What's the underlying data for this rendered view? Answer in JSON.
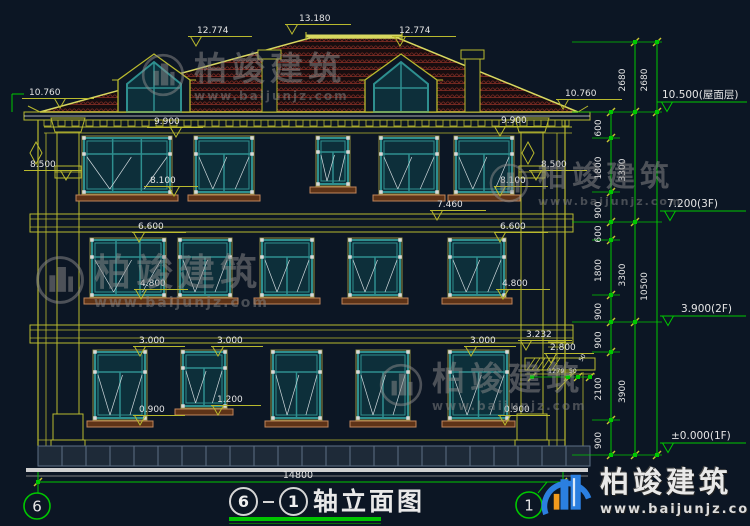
{
  "drawing": {
    "title": {
      "axis_a": "6",
      "axis_b": "1",
      "name": "轴立面图"
    },
    "bottom_dim": {
      "value": "14800"
    },
    "axis_bubbles": [
      "6",
      "1"
    ]
  },
  "watermark": {
    "brand": "柏竣建筑",
    "site": "www.baijunjz.com"
  },
  "logo": {
    "brand": "柏竣建筑",
    "site": "www.baijunjz.com"
  },
  "annotations": [
    {
      "t": "13.180",
      "x": 299,
      "y": 13,
      "lx": 285,
      "lw": 66,
      "tri": 292
    },
    {
      "t": "12.774",
      "x": 197,
      "y": 25,
      "lx": 188,
      "lw": 64,
      "tri": 196
    },
    {
      "t": "12.774",
      "x": 399,
      "y": 25,
      "lx": 392,
      "lw": 64,
      "tri": 400
    },
    {
      "t": "10.760",
      "x": 29,
      "y": 87,
      "lx": 22,
      "lw": 72,
      "tri": 60
    },
    {
      "t": "10.760",
      "x": 565,
      "y": 88,
      "lx": 556,
      "lw": 66,
      "tri": 563
    },
    {
      "t": "9.900",
      "x": 154,
      "y": 116,
      "lx": 147,
      "lw": 56,
      "tri": 176
    },
    {
      "t": "9.900",
      "x": 501,
      "y": 115,
      "lx": 494,
      "lw": 56,
      "tri": 500
    },
    {
      "t": "8.500",
      "x": 30,
      "y": 159,
      "lx": 24,
      "lw": 58,
      "tri": 66
    },
    {
      "t": "8.500",
      "x": 541,
      "y": 159,
      "lx": 529,
      "lw": 58,
      "tri": 536
    },
    {
      "t": "8.100",
      "x": 150,
      "y": 175,
      "lx": 144,
      "lw": 54,
      "tri": 174
    },
    {
      "t": "8.100",
      "x": 500,
      "y": 175,
      "lx": 494,
      "lw": 54,
      "tri": 500
    },
    {
      "t": "7.460",
      "x": 437,
      "y": 199,
      "lx": 430,
      "lw": 56,
      "tri": 437
    },
    {
      "t": "6.600",
      "x": 138,
      "y": 221,
      "lx": 132,
      "lw": 54,
      "tri": 139
    },
    {
      "t": "6.600",
      "x": 500,
      "y": 221,
      "lx": 494,
      "lw": 54,
      "tri": 500
    },
    {
      "t": "4.800",
      "x": 140,
      "y": 278,
      "lx": 134,
      "lw": 54,
      "tri": 141
    },
    {
      "t": "4.800",
      "x": 502,
      "y": 278,
      "lx": 496,
      "lw": 54,
      "tri": 503
    },
    {
      "t": "3.000",
      "x": 139,
      "y": 335,
      "lx": 133,
      "lw": 52,
      "tri": 140
    },
    {
      "t": "3.000",
      "x": 217,
      "y": 335,
      "lx": 211,
      "lw": 52,
      "tri": 218
    },
    {
      "t": "3.000",
      "x": 470,
      "y": 335,
      "lx": 464,
      "lw": 52,
      "tri": 471
    },
    {
      "t": "1.200",
      "x": 217,
      "y": 394,
      "lx": 211,
      "lw": 50,
      "tri": 218
    },
    {
      "t": "0.900",
      "x": 139,
      "y": 404,
      "lx": 133,
      "lw": 52,
      "tri": 140
    },
    {
      "t": "0.900",
      "x": 504,
      "y": 404,
      "lx": 498,
      "lw": 52,
      "tri": 505
    },
    {
      "t": "3.232",
      "x": 526,
      "y": 329,
      "lx": 518,
      "lw": 54,
      "tri": 526
    },
    {
      "t": "2.800",
      "x": 550,
      "y": 342,
      "lx": 544,
      "lw": 50,
      "tri": 551
    }
  ],
  "right_levels": [
    {
      "t": "10.500(屋面层)",
      "x": 662,
      "y": 87,
      "ly": 102,
      "lx": 657,
      "lw": 90,
      "tri": 667
    },
    {
      "t": "7.200(3F)",
      "x": 667,
      "y": 196,
      "ly": 211,
      "lx": 660,
      "lw": 86,
      "tri": 670
    },
    {
      "t": "3.900(2F)",
      "x": 681,
      "y": 301,
      "ly": 316,
      "lx": 660,
      "lw": 86,
      "tri": 668
    },
    {
      "t": "±0.000(1F)",
      "x": 671,
      "y": 428,
      "ly": 443,
      "lx": 660,
      "lw": 86,
      "tri": 668
    }
  ],
  "chains": [
    {
      "x": 611,
      "lx": 601,
      "ticks": [
        112,
        138,
        192,
        222,
        240,
        295,
        322,
        352,
        420,
        455
      ],
      "labels": [
        "600",
        "1800",
        "900",
        "600",
        "1800",
        "900",
        "900",
        "2100",
        "900"
      ]
    },
    {
      "x": 635,
      "lx": 625,
      "ticks": [
        42,
        112,
        222,
        322,
        455
      ],
      "labels": [
        "2680",
        "3300",
        "3300",
        "3900"
      ]
    },
    {
      "x": 657,
      "lx": 647,
      "ticks": [
        42,
        112,
        455
      ],
      "labels": [
        "2680",
        "10500"
      ]
    }
  ],
  "small_dims": {
    "width": "1279",
    "a": "50",
    "b": "50"
  }
}
